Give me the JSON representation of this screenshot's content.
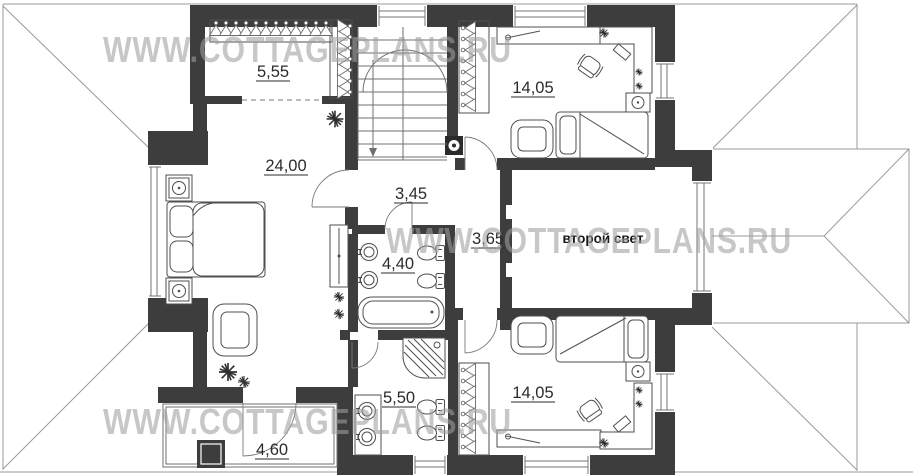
{
  "watermarks": [
    {
      "text": "WWW.COTTAGEPLANS.RU"
    },
    {
      "text": "WWW.COTTAGEPLANS.RU"
    },
    {
      "text": "WWW.COTTAGEPLANS.RU"
    }
  ],
  "rooms": {
    "wardrobe": {
      "area": "5,55"
    },
    "master_bedroom": {
      "area": "24,00"
    },
    "bedroom_top": {
      "area": "14,05"
    },
    "hall_upper": {
      "area": "3,45"
    },
    "hall_lower": {
      "area": "3,65"
    },
    "bathroom_upper": {
      "area": "4,40"
    },
    "second_light": {
      "label": "второй свет"
    },
    "bathroom_lower": {
      "area": "5,50"
    },
    "bedroom_bottom": {
      "area": "14,05"
    },
    "balcony": {
      "area": "4,60"
    }
  },
  "colors": {
    "wall": "#3d3d3d",
    "roof_line": "#9a9a9a",
    "furniture_line": "#4f4f4f",
    "watermark": "#9f9f9f",
    "label": "#2b2b2b"
  }
}
